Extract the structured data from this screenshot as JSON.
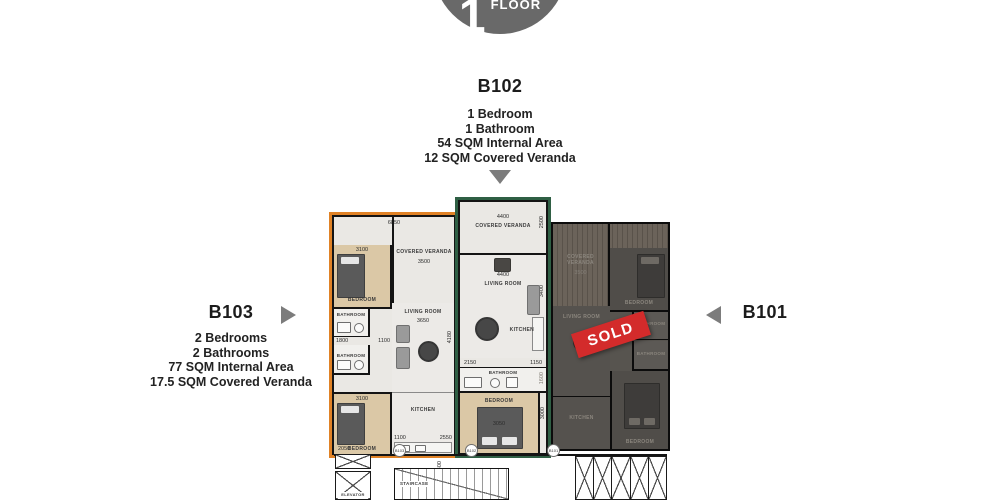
{
  "badge": {
    "number": "1",
    "label": "FLOOR"
  },
  "units": {
    "b102": {
      "name": "B102",
      "details": [
        "1 Bedroom",
        "1 Bathroom",
        "54 SQM Internal Area",
        "12 SQM Covered Veranda"
      ]
    },
    "b103": {
      "name": "B103",
      "details": [
        "2 Bedrooms",
        "2 Bathrooms",
        "77 SQM Internal Area",
        "17.5 SQM Covered Veranda"
      ]
    },
    "b101": {
      "name": "B101",
      "status": "SOLD"
    }
  },
  "plan": {
    "labels": {
      "covered_veranda": "COVERED VERANDA",
      "living_room": "LIVING ROOM",
      "bedroom": "BEDROOM",
      "bathroom": "BATHROOM",
      "kitchen": "KITCHEN",
      "staircase": "STAIRCASE",
      "elevator": "ELEVATOR"
    },
    "dims": {
      "d6850": "6850",
      "d3500": "3500",
      "d3100": "3100",
      "d1800": "1800",
      "d1100": "1100",
      "d3650": "3650",
      "d4180": "4180",
      "d2550": "2550",
      "d4400": "4400",
      "d2500": "2500",
      "d3400": "3400",
      "d2150": "2150",
      "d1150": "1150",
      "d1600": "1600",
      "d3050": "3050",
      "d3000": "3000",
      "d1400": "1400",
      "d2050": "2050"
    }
  },
  "colors": {
    "accent_orange": "#E08226",
    "accent_green": "#2F5F44",
    "sold_red": "#D32B2B",
    "badge_grey": "#696969",
    "arrow_grey": "#7C7C7C"
  }
}
